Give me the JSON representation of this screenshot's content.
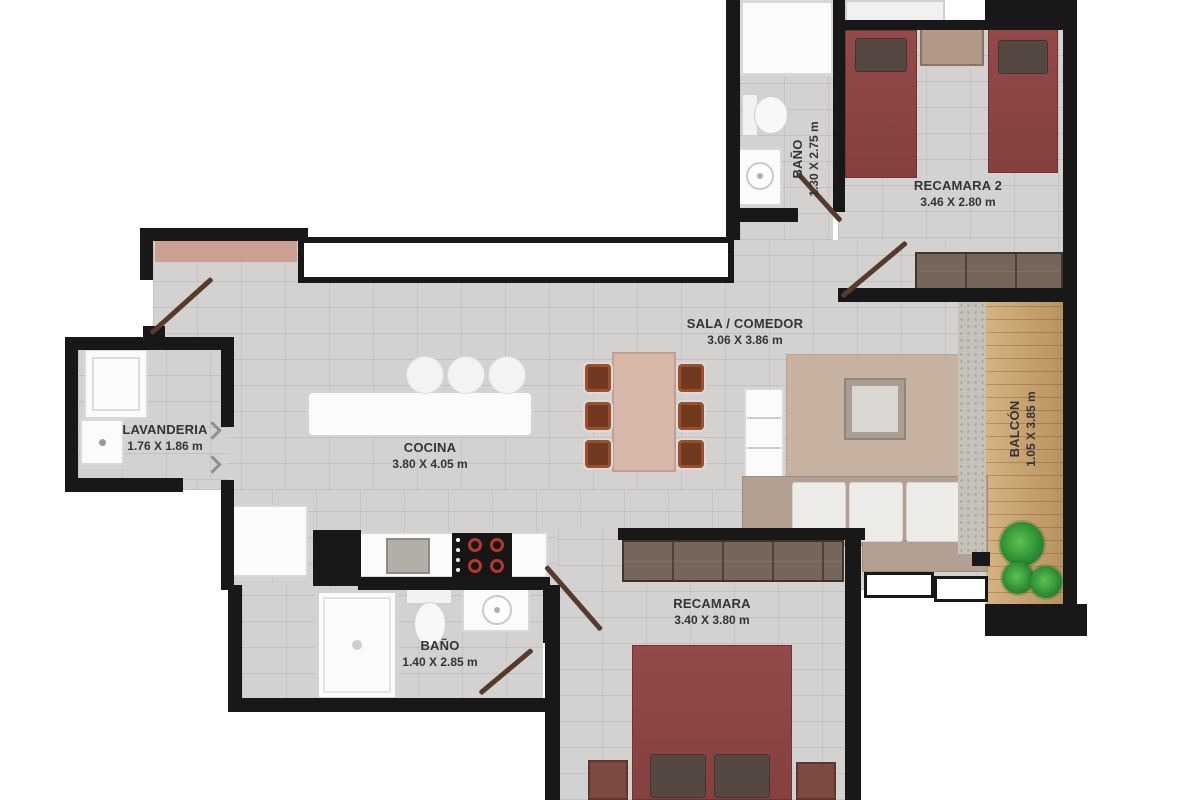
{
  "rooms": {
    "bano_top": {
      "name": "BAÑO",
      "dims": "1.30 X 2.75 m"
    },
    "recamara2": {
      "name": "RECAMARA 2",
      "dims": "3.46 X 2.80 m"
    },
    "sala_comedor": {
      "name": "SALA / COMEDOR",
      "dims": "3.06 X 3.86 m"
    },
    "lavanderia": {
      "name": "LAVANDERIA",
      "dims": "1.76 X 1.86 m"
    },
    "cocina": {
      "name": "COCINA",
      "dims": "3.80 X 4.05 m"
    },
    "balcon": {
      "name": "BALCÓN",
      "dims": "1.05 X 3.85 m"
    },
    "bano_bottom": {
      "name": "BAÑO",
      "dims": "1.40 X 2.85 m"
    },
    "recamara": {
      "name": "RECAMARA",
      "dims": "3.40 X 3.80 m"
    }
  },
  "colors": {
    "wall": "#181818",
    "floor_tile": "#d3d2d0",
    "balcony_wood": "#cda269",
    "bed_maroon": "#8e4746",
    "closet_brown": "#75655b",
    "dining_chair": "#9c4f2c",
    "dining_table": "#d8b7ab",
    "rug": "#c7b2a2",
    "sofa": "#b2a192",
    "plant_green": "#2f8f35",
    "entry_mat": "#c9a093"
  }
}
